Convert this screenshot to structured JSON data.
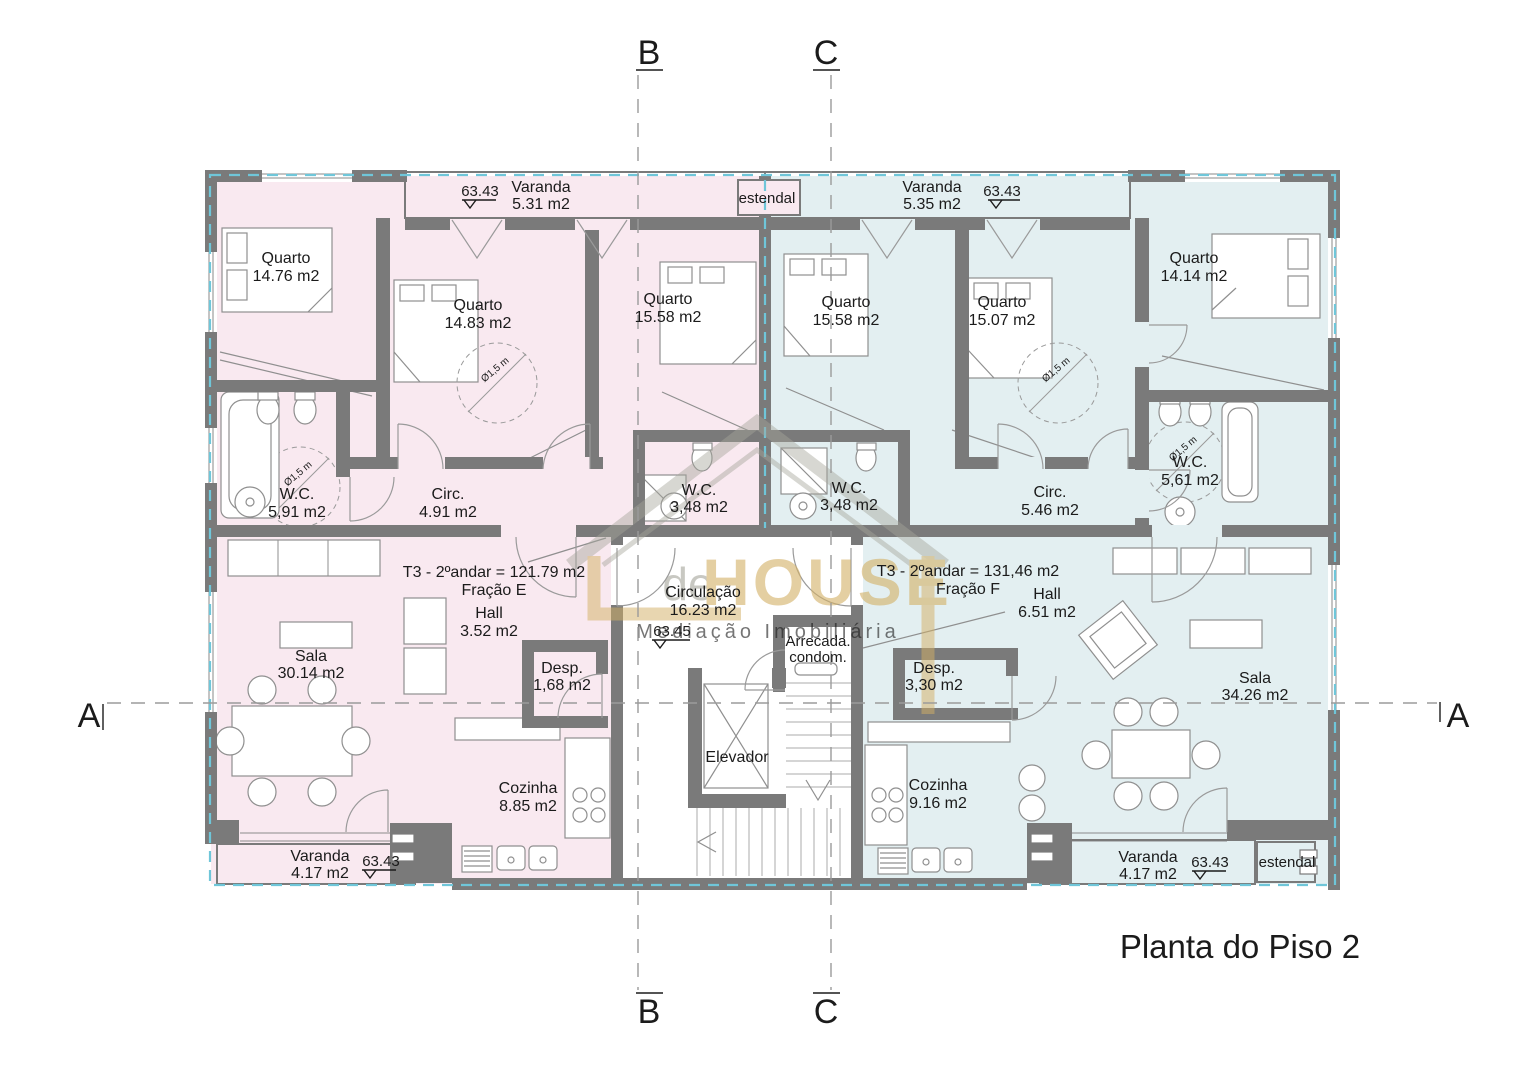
{
  "page": {
    "title": "Planta do Piso 2"
  },
  "watermark": {
    "prefix": "de",
    "brand": "HOUSE",
    "tagline": "Mediação Imobiliária"
  },
  "sections": {
    "a": "A",
    "b": "B",
    "c": "C"
  },
  "levels": {
    "main": "63.43",
    "stair": "63.45"
  },
  "annotations": {
    "diameter": "Ø1,5 m",
    "estendal": "estendal",
    "elevador": "Elevador",
    "circulacao": {
      "name": "Circulação",
      "area": "16.23 m2"
    },
    "arrecada": {
      "line1": "Arrecada.",
      "line2": "condom."
    }
  },
  "fraction_e": {
    "summary": "T3 - 2ºandar = 121.79 m2",
    "fraction": "Fração E",
    "varanda_top": {
      "name": "Varanda",
      "area": "5.31 m2"
    },
    "quarto1": {
      "name": "Quarto",
      "area": "14.76 m2"
    },
    "quarto2": {
      "name": "Quarto",
      "area": "14.83 m2"
    },
    "quarto3": {
      "name": "Quarto",
      "area": "15.58 m2"
    },
    "wc_main": {
      "name": "W.C.",
      "area": "5,91 m2"
    },
    "circ": {
      "name": "Circ.",
      "area": "4.91 m2"
    },
    "wc_small": {
      "name": "W.C.",
      "area": "3,48 m2"
    },
    "hall": {
      "name": "Hall",
      "area": "3.52 m2"
    },
    "desp": {
      "name": "Desp.",
      "area": "1,68 m2"
    },
    "sala": {
      "name": "Sala",
      "area": "30.14 m2"
    },
    "cozinha": {
      "name": "Cozinha",
      "area": "8.85 m2"
    },
    "varanda_bottom": {
      "name": "Varanda",
      "area": "4.17 m2"
    }
  },
  "fraction_f": {
    "summary": "T3 - 2ºandar = 131,46 m2",
    "fraction": "Fração F",
    "varanda_top": {
      "name": "Varanda",
      "area": "5.35 m2"
    },
    "quarto1": {
      "name": "Quarto",
      "area": "15.58 m2"
    },
    "quarto2": {
      "name": "Quarto",
      "area": "15.07 m2"
    },
    "quarto3": {
      "name": "Quarto",
      "area": "14.14 m2"
    },
    "wc_small": {
      "name": "W.C.",
      "area": "3,48 m2"
    },
    "circ": {
      "name": "Circ.",
      "area": "5.46 m2"
    },
    "wc_main": {
      "name": "W.C.",
      "area": "5,61 m2"
    },
    "hall": {
      "name": "Hall",
      "area": "6.51 m2"
    },
    "desp": {
      "name": "Desp.",
      "area": "3,30 m2"
    },
    "sala": {
      "name": "Sala",
      "area": "34.26 m2"
    },
    "cozinha": {
      "name": "Cozinha",
      "area": "9.16 m2"
    },
    "varanda_bottom": {
      "name": "Varanda",
      "area": "4.17 m2"
    }
  },
  "colors": {
    "fraction_e_fill": "#f9e9f0",
    "fraction_f_fill": "#e3eff1",
    "wall": "#7a7a7a",
    "boundary_dash": "#6fc6d9",
    "brand_gold": "#d3b065"
  }
}
